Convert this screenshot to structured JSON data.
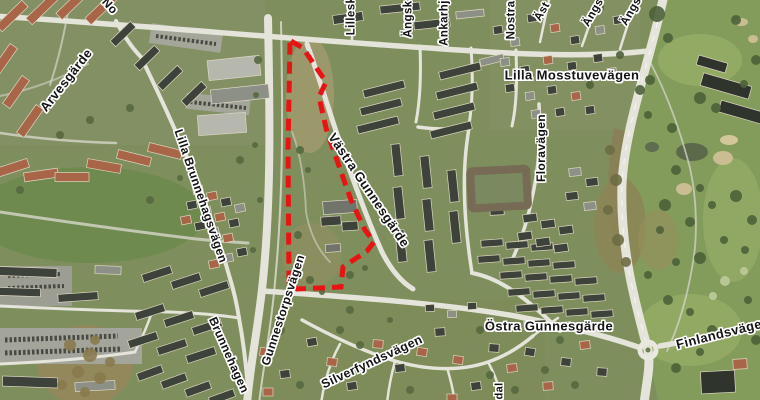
{
  "map": {
    "boundary": {
      "color": "#e81414",
      "dash": "12 7",
      "points": "291,41 303,48 326,82 319,97 327,132 351,200 365,230 374,242 367,251 343,267 341,287 297,289 289,282 288,150 290,42"
    },
    "road_labels": [
      {
        "name": "norra-partial",
        "text": "No"
      },
      {
        "name": "lillesk-partial",
        "text": "Lillesk"
      },
      {
        "name": "angsk-partial",
        "text": "Ängsk"
      },
      {
        "name": "ankarhj-partial",
        "text": "Ankarhj"
      },
      {
        "name": "nostra-partial",
        "text": "Nostra"
      },
      {
        "name": "ast-partial",
        "text": "Äst"
      },
      {
        "name": "angs-partial-1",
        "text": "Ängs"
      },
      {
        "name": "angs-partial-2",
        "text": "Ängs"
      },
      {
        "name": "lilla-mosstuvevagen",
        "text": "Lilla Mosstuvevägen"
      },
      {
        "name": "arvesgarde",
        "text": "Arvesgärde"
      },
      {
        "name": "lilla-brunnehagsvagen",
        "text": "Lilla Brunnehagsvägen"
      },
      {
        "name": "vastra-gunnesgarde",
        "text": "Västra Gunnesgärde"
      },
      {
        "name": "floravagen",
        "text": "Floravägen"
      },
      {
        "name": "gunnestorpsvagen",
        "text": "Gunnestorpsvägen"
      },
      {
        "name": "brunnehagen",
        "text": "Brunnehagen"
      },
      {
        "name": "ostra-gunnesgarde",
        "text": "Östra Gunnesgärde"
      },
      {
        "name": "finlandsvagen",
        "text": "Finlandsvägen"
      },
      {
        "name": "silverfyndsvagen",
        "text": "Silverfyndsvägen"
      },
      {
        "name": "dal-partial",
        "text": "dal"
      }
    ]
  }
}
